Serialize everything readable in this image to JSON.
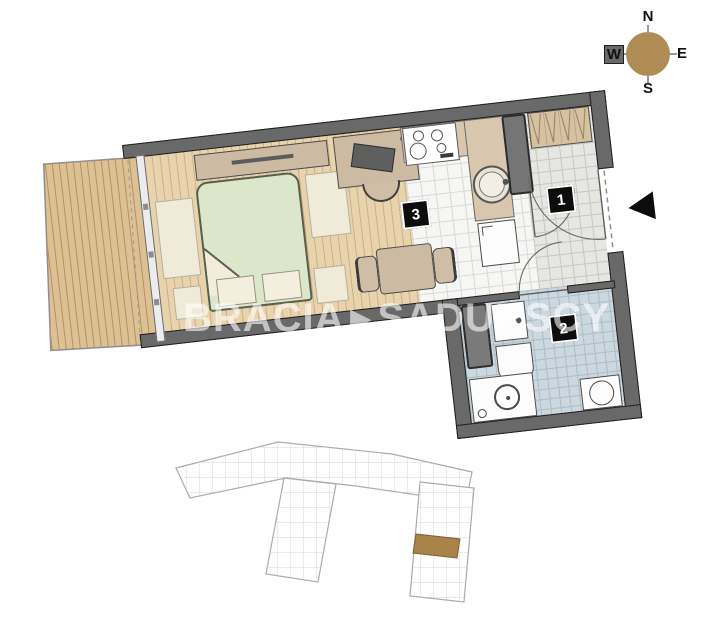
{
  "compass": {
    "north": "N",
    "south": "S",
    "east": "E",
    "west": "W"
  },
  "rooms": [
    {
      "number": "1",
      "type": "hall"
    },
    {
      "number": "2",
      "type": "bathroom"
    },
    {
      "number": "3",
      "type": "living-room-with-kitchenette"
    }
  ],
  "watermark": {
    "left": "BRACIA",
    "arrow": "▶",
    "right": "SADURSCY"
  },
  "colors": {
    "wall": "#696969",
    "balcony_deck": "#ddc094",
    "balcony_stripe": "#b2935f",
    "wood_floor": "#e9d3ac",
    "kitchen_tile": "#f6f6f4",
    "hall_tile": "#e6e6e3",
    "bath_tile": "#ccd8e0",
    "bed": "#dbe6ca",
    "furniture": "#cdbaa3",
    "compass_rose": "#b08c55",
    "minimap_highlight": "#a8834a",
    "room_label_bg": "#0d0d0d"
  }
}
